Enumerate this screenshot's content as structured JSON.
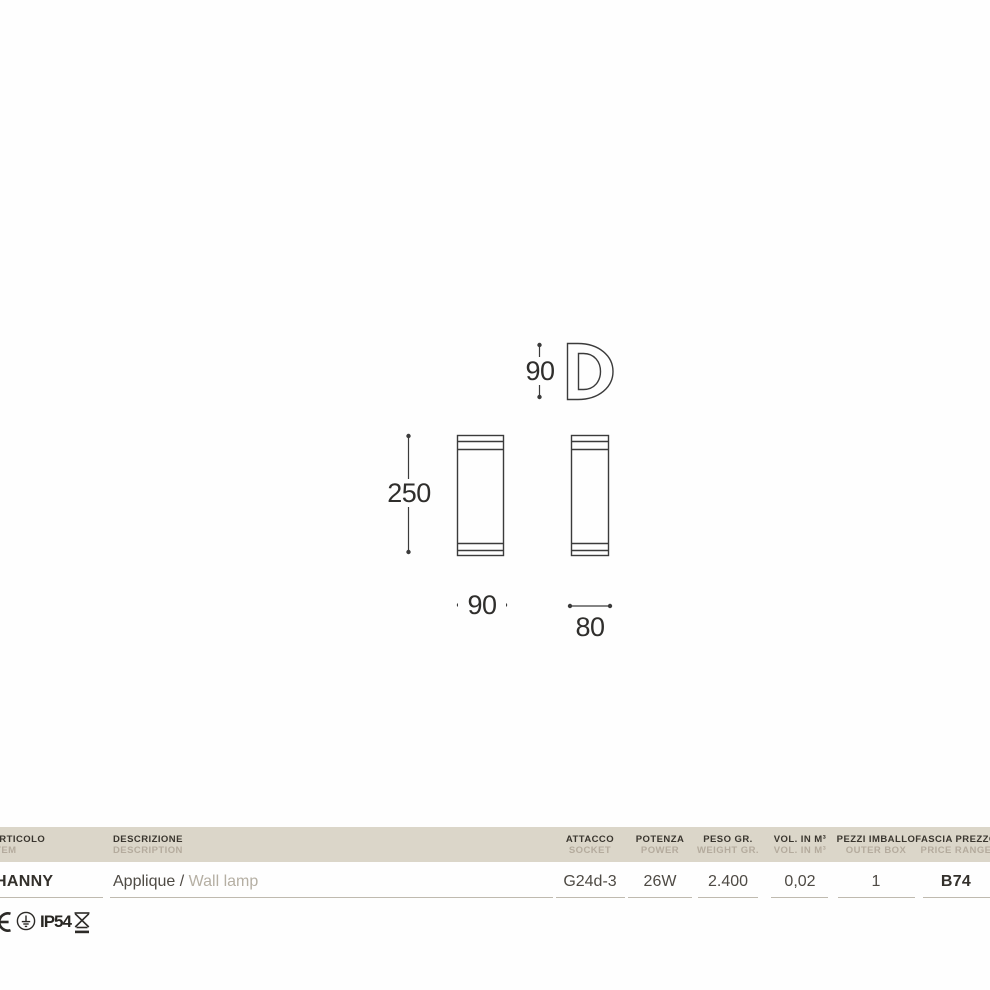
{
  "drawing": {
    "dim_profile_height": "90",
    "dim_body_height": "250",
    "dim_body_width": "90",
    "dim_body_depth": "80"
  },
  "table": {
    "headers": [
      {
        "it": "ARTICOLO",
        "en": "ITEM"
      },
      {
        "it": "DESCRIZIONE",
        "en": "DESCRIPTION"
      },
      {
        "it": "ATTACCO",
        "en": "SOCKET"
      },
      {
        "it": "POTENZA",
        "en": "POWER"
      },
      {
        "it": "PESO GR.",
        "en": "WEIGHT GR."
      },
      {
        "it": "VOL. IN M³",
        "en": "VOL. IN M³"
      },
      {
        "it": "PEZZI IMBALLO",
        "en": "OUTER BOX"
      },
      {
        "it": "FASCIA PREZZO",
        "en": "PRICE RANGE"
      }
    ],
    "row": {
      "item": "HANNY",
      "description_it": "Applique /",
      "description_en": " Wall lamp",
      "socket": "G24d-3",
      "power": "26W",
      "weight": "2.400",
      "volume": "0,02",
      "pieces": "1",
      "price_range": "B74"
    }
  },
  "certs": {
    "ip_rating": "IP54",
    "icons": [
      "ce-mark-icon",
      "earth-symbol-icon",
      "weee-crossed-bin-icon"
    ]
  },
  "colors": {
    "table_header_bg": "#dbd6c9",
    "drawing_line": "#3b3b3b",
    "muted_text": "#b4ab9d",
    "dark_text": "#39352e",
    "page_bg": "#fefefe"
  }
}
